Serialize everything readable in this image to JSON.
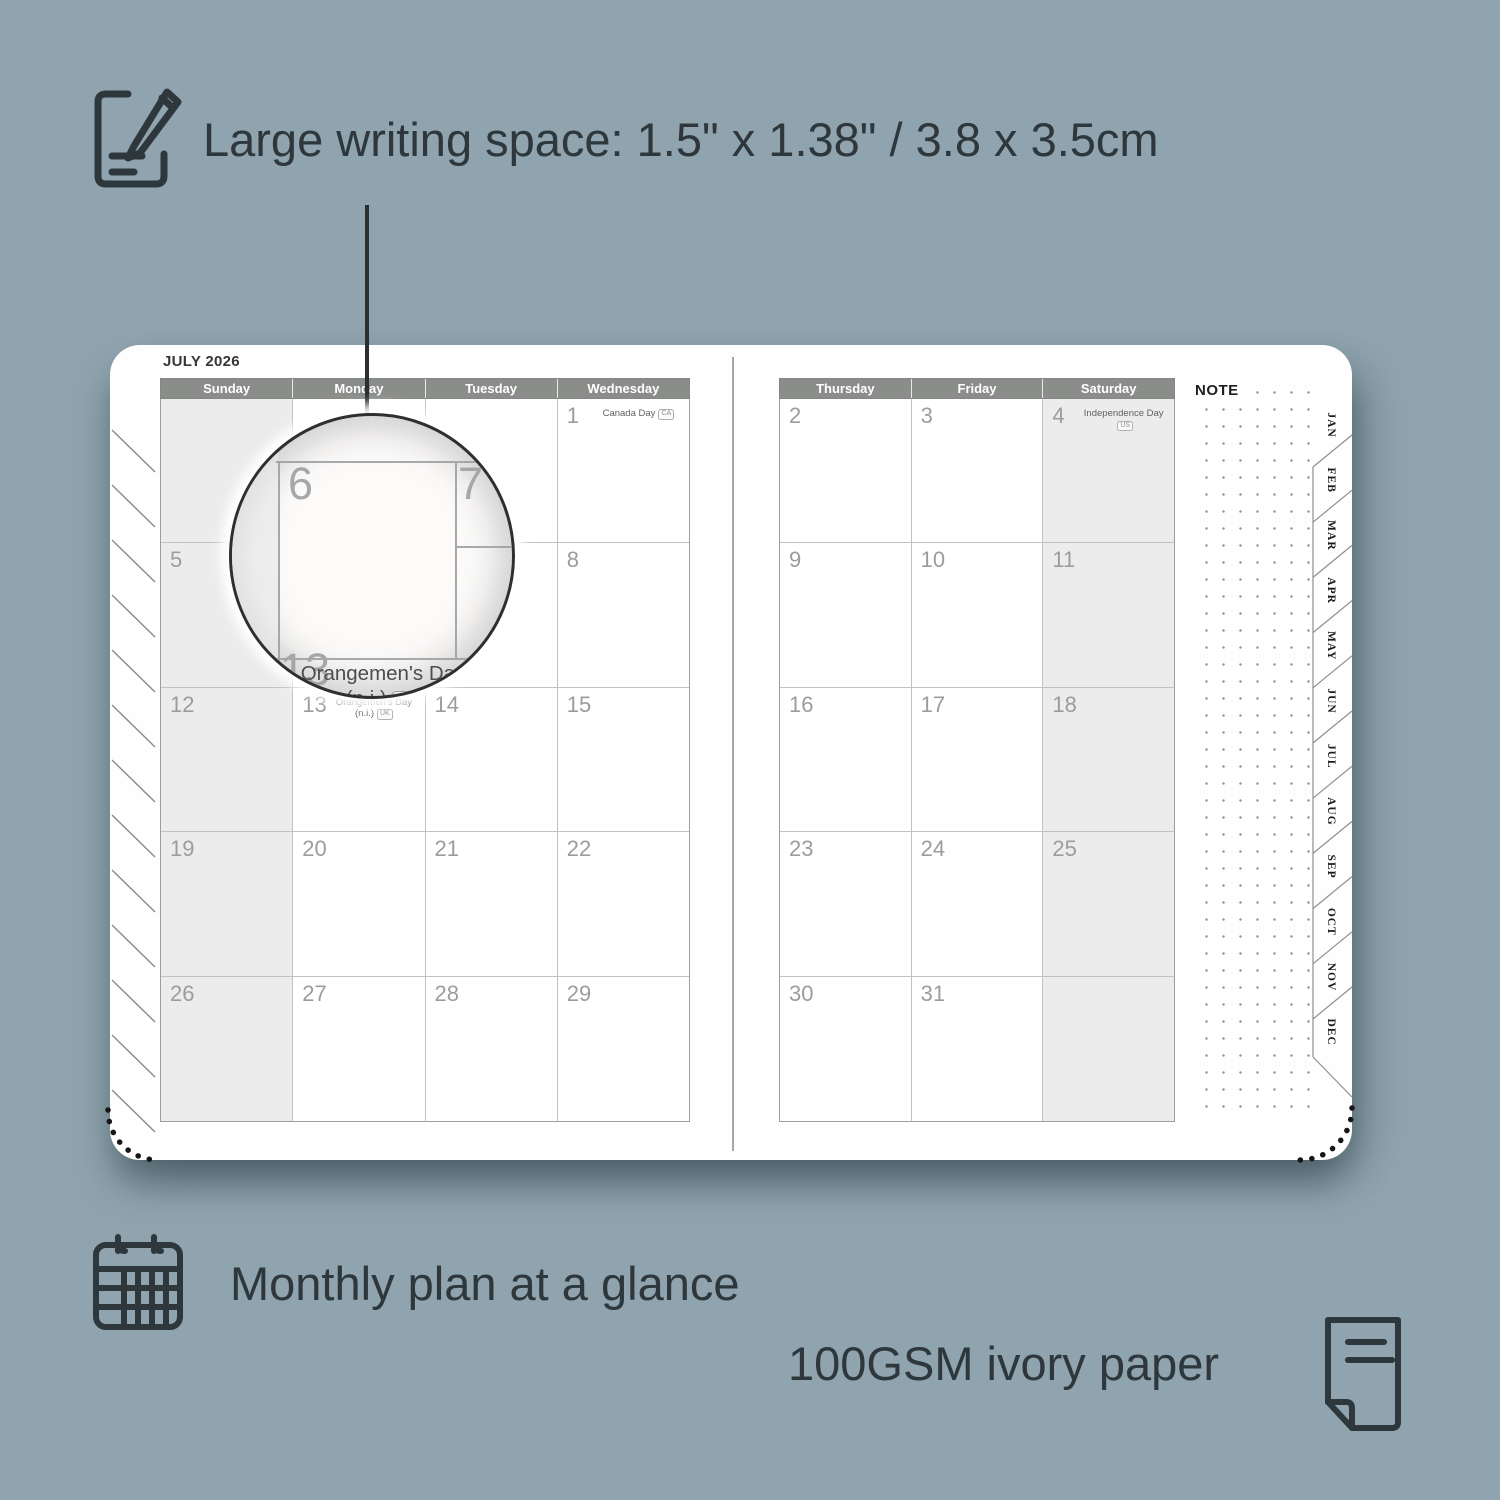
{
  "annotations": {
    "writing_space": {
      "text": "Large writing space: 1.5\" x 1.38\" / 3.8 x 3.5cm"
    },
    "monthly_plan": {
      "text": "Monthly plan at a glance"
    },
    "paper": {
      "text": "100GSM ivory paper"
    }
  },
  "planner": {
    "month_title": "JULY 2026",
    "note_label": "NOTE",
    "month_tabs": [
      "JAN",
      "FEB",
      "MAR",
      "APR",
      "MAY",
      "JUN",
      "JUL",
      "AUG",
      "SEP",
      "OCT",
      "NOV",
      "DEC"
    ],
    "left_page": {
      "day_headers": [
        "Sunday",
        "Monday",
        "Tuesday",
        "Wednesday"
      ],
      "shaded_column": 0,
      "rows": [
        [
          {
            "day": ""
          },
          {
            "day": ""
          },
          {
            "day": ""
          },
          {
            "day": "1",
            "holiday": {
              "lines": [
                "Canada Day"
              ],
              "badge": "CA"
            }
          }
        ],
        [
          {
            "day": "5"
          },
          {
            "day": "6"
          },
          {
            "day": "7"
          },
          {
            "day": "8"
          }
        ],
        [
          {
            "day": "12"
          },
          {
            "day": "13",
            "holiday": {
              "lines": [
                "Orangemen's Day",
                "(n.i.)"
              ],
              "badge": "UK"
            }
          },
          {
            "day": "14"
          },
          {
            "day": "15"
          }
        ],
        [
          {
            "day": "19"
          },
          {
            "day": "20"
          },
          {
            "day": "21"
          },
          {
            "day": "22"
          }
        ],
        [
          {
            "day": "26"
          },
          {
            "day": "27"
          },
          {
            "day": "28"
          },
          {
            "day": "29"
          }
        ]
      ]
    },
    "right_page": {
      "day_headers": [
        "Thursday",
        "Friday",
        "Saturday"
      ],
      "shaded_column": 2,
      "rows": [
        [
          {
            "day": "2"
          },
          {
            "day": "3"
          },
          {
            "day": "4",
            "holiday": {
              "lines": [
                "Independence Day"
              ],
              "badge": "US"
            }
          }
        ],
        [
          {
            "day": "9"
          },
          {
            "day": "10"
          },
          {
            "day": "11"
          }
        ],
        [
          {
            "day": "16"
          },
          {
            "day": "17"
          },
          {
            "day": "18"
          }
        ],
        [
          {
            "day": "23"
          },
          {
            "day": "24"
          },
          {
            "day": "25"
          }
        ],
        [
          {
            "day": "30"
          },
          {
            "day": "31"
          },
          {
            "day": ""
          }
        ]
      ]
    },
    "magnifier": {
      "day_left": "6",
      "day_right": "7",
      "day_bottom": "13",
      "holiday_line1": "Orangemen's Day",
      "holiday_line2": "(n.i.)",
      "badge": "UK"
    }
  },
  "colors": {
    "background": "#8fa4ae",
    "ink": "#2d373c",
    "header_bg": "#8b8d8a",
    "shaded_cell": "#ececec",
    "page": "#fefefe",
    "day_number": "#9c9c9c"
  }
}
